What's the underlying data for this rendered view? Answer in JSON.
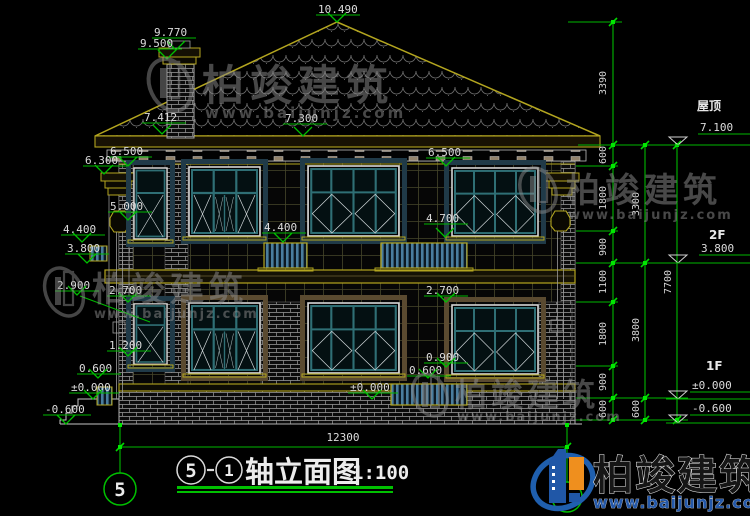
{
  "drawing_title": {
    "axis_start": "5",
    "axis_end": "1",
    "name": "轴立面图",
    "scale": "1:100"
  },
  "axis_bubble_left": "5",
  "total_width_dim": "12300",
  "levels": {
    "peak": "10.490",
    "chimney_top": "9.770",
    "chimney_cap": "9.500",
    "eave_left": "7.412",
    "eave_right": "7.300",
    "v6500": "6.500",
    "v6300": "6.300",
    "v5000": "5.000",
    "v4700": "4.700",
    "v4400": "4.400",
    "v3800": "3.800",
    "v2900": "2.900",
    "v2700": "2.700",
    "v1200": "1.200",
    "v0900": "0.900",
    "v0600": "0.600",
    "v0000": "±0.000",
    "vm0600": "-0.600"
  },
  "dims_right": {
    "chain_inner": [
      "3390",
      "600",
      "1800",
      "900",
      "1100",
      "1800",
      "900",
      "600"
    ],
    "chain_mid": [
      "3300",
      "3800",
      "600"
    ],
    "chain_outer": [
      "7700"
    ]
  },
  "levels_right": [
    {
      "name": "屋顶",
      "value": "7.100"
    },
    {
      "name": "2F",
      "value": "3.800"
    },
    {
      "name": "1F",
      "value": "±0.000"
    },
    {
      "name": "",
      "value": "-0.600"
    }
  ],
  "watermark": {
    "brand": "柏竣建筑",
    "url": "www.baijunjz.com"
  },
  "logo": {
    "brand": "柏竣建筑",
    "url": "www.baijunjz.com"
  }
}
